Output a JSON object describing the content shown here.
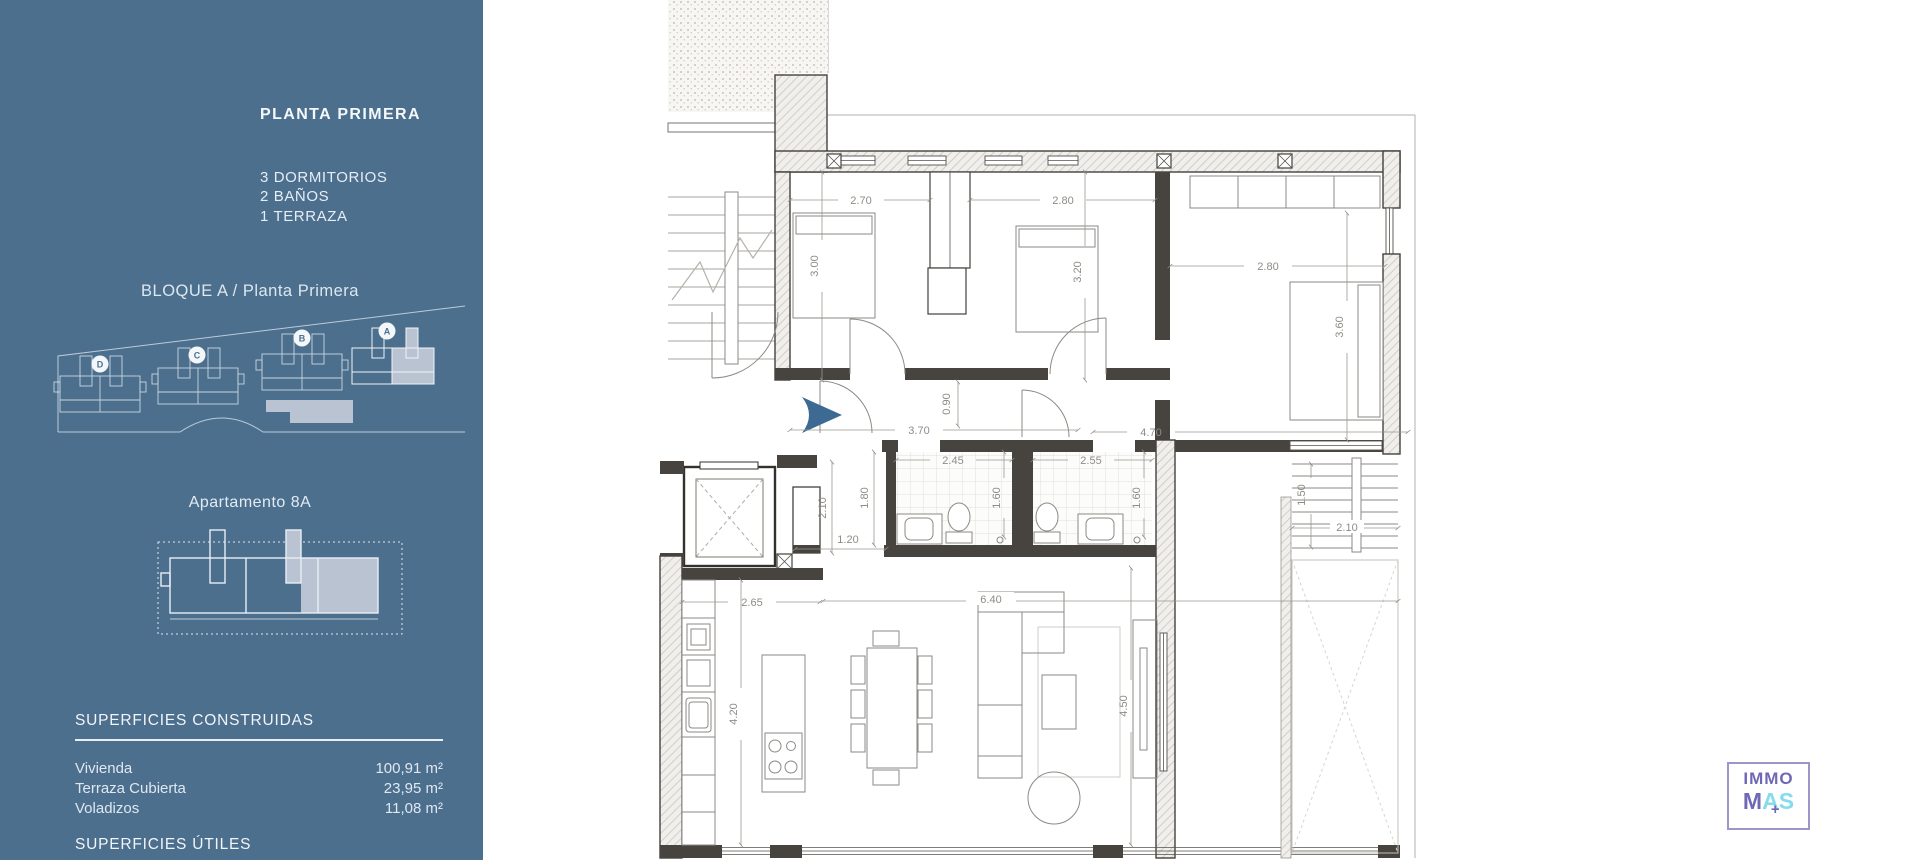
{
  "sidebar": {
    "bg": "#4c6f8e",
    "title": "PLANTA PRIMERA",
    "features": [
      "3 DORMITORIOS",
      "2 BAÑOS",
      "1 TERRAZA"
    ],
    "block_label": "BLOQUE A / Planta Primera",
    "site_blocks": [
      "D",
      "C",
      "B",
      "A"
    ],
    "apartment_label": "Apartamento 8A",
    "surfaces_built": {
      "title": "SUPERFICIES CONSTRUIDAS",
      "rows": [
        {
          "label": "Vivienda",
          "value": "100,91 m²"
        },
        {
          "label": "Terraza Cubierta",
          "value": "23,95 m²"
        },
        {
          "label": "Voladizos",
          "value": "11,08 m²"
        }
      ]
    },
    "surfaces_useful": {
      "title": "SUPERFICIES ÚTILES"
    }
  },
  "floorplan": {
    "dims": {
      "bed1_w": "2.70",
      "bed1_d": "3.00",
      "bed2_w": "2.80",
      "bed2_d": "3.20",
      "bed3_w": "2.80",
      "bed3_d": "3.60",
      "hall_left": "3.70",
      "hall_mid": "0.90",
      "hall_right": "4.70",
      "hall_depth": "2.10",
      "hall_width": "1.20",
      "nook": "1.80",
      "bath1_w": "2.45",
      "bath1_d": "1.60",
      "bath2_w": "2.55",
      "bath2_d": "1.60",
      "stairs_d": "1.50",
      "stairs_w": "2.10",
      "kitchen_w": "2.65",
      "living_w": "6.40",
      "kitchen_d": "4.20",
      "living_d": "4.50"
    },
    "accent_arrow_color": "#3d6a92"
  },
  "logo": {
    "word1": "IMMO",
    "m": "M",
    "a": "A",
    "s": "S",
    "plus": "+"
  }
}
